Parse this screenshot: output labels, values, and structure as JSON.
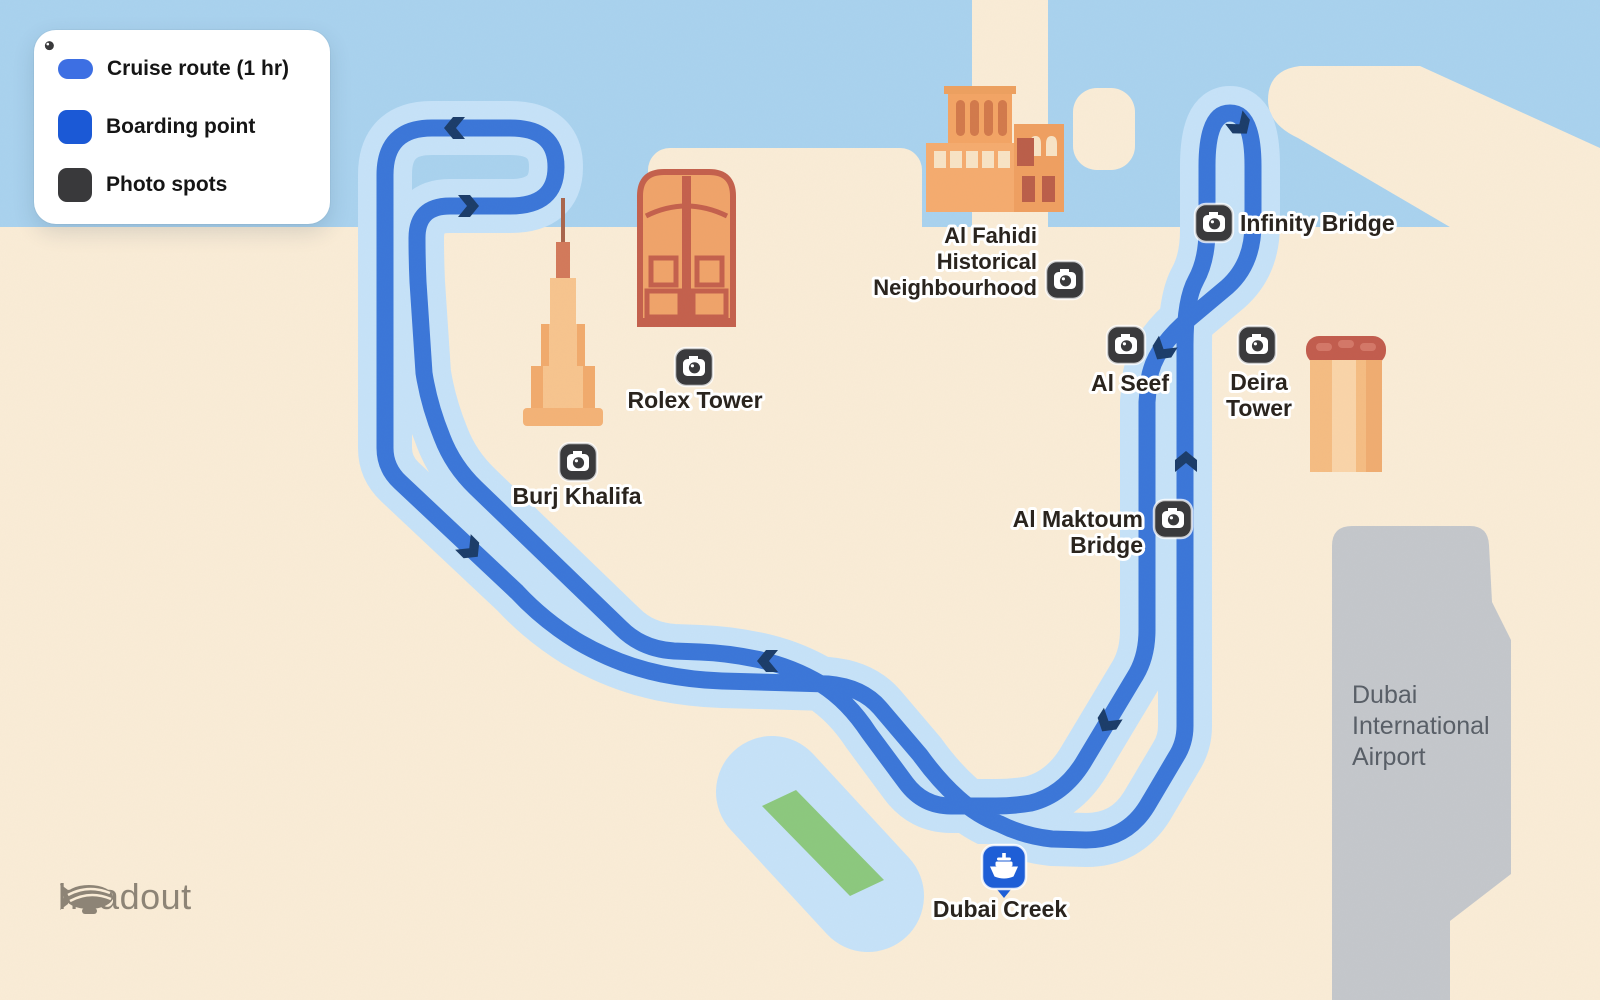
{
  "legend": {
    "items": [
      {
        "key": "cruise-route",
        "icon": "route-pill-icon",
        "label": "Cruise route (1 hr)"
      },
      {
        "key": "boarding-point",
        "icon": "boat-icon",
        "label": "Boarding point"
      },
      {
        "key": "photo-spots",
        "icon": "camera-icon",
        "label": "Photo spots"
      }
    ]
  },
  "map": {
    "route": {
      "name": "Dubai Creek cruise loop",
      "duration": "1 hr"
    },
    "labels": {
      "burj": "Burj Khalifa",
      "rolex": "Rolex Tower",
      "fahidi1": "Al Fahidi",
      "fahidi2": "Historical",
      "fahidi3": "Neighbourhood",
      "alseef": "Al Seef",
      "deira1": "Deira",
      "deira2": "Tower",
      "infinity": "Infinity Bridge",
      "maktoum1": "Al Maktoum",
      "maktoum2": "Bridge",
      "creek": "Dubai Creek",
      "airport1": "Dubai",
      "airport2": "International",
      "airport3": "Airport"
    },
    "photo_spots": [
      "Burj Khalifa",
      "Rolex Tower",
      "Al Fahidi Historical Neighbourhood",
      "Al Seef",
      "Deira Tower",
      "Infinity Bridge",
      "Al Maktoum Bridge"
    ],
    "boarding_point": "Dubai Creek",
    "colors": {
      "sea": "#A9D2EE",
      "land": "#FAECD6",
      "channel": "#C6E2F8",
      "route": "#3B76D8",
      "arrow": "#1B3C69",
      "park_green": "#8CC87D",
      "airport_gray": "#C4C7CB",
      "marker_dark": "#3A3A3C",
      "pin_blue": "#1E5ED6",
      "building_orange": "#F0A369",
      "building_outline": "#C4604C"
    }
  },
  "brand": "headout"
}
